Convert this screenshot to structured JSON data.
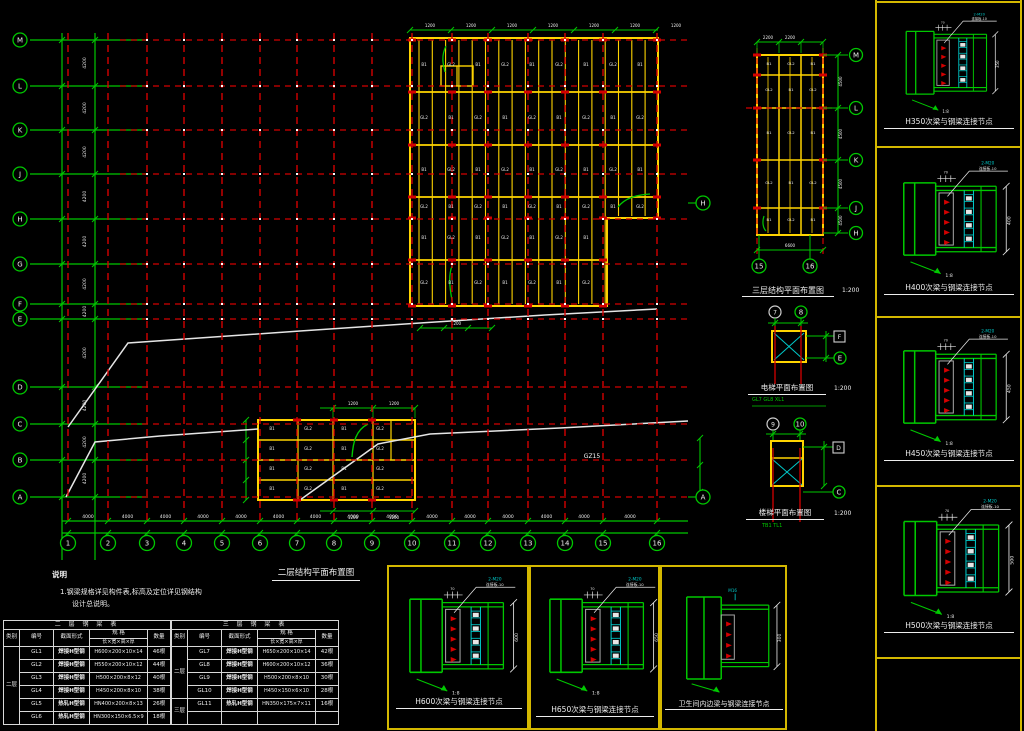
{
  "colors": {
    "green": "#00c800",
    "red": "#d40000",
    "yellow": "#ffd400",
    "panel_border": "#d4b800",
    "cyan": "#00c8c8",
    "white": "#ededed",
    "gray_plate": "#a8a8a8"
  },
  "axes": {
    "cols": [
      "1",
      "2",
      "3",
      "4",
      "5",
      "6",
      "7",
      "8",
      "9",
      "10",
      "11",
      "12",
      "13",
      "14",
      "15",
      "16"
    ],
    "rows": [
      "M",
      "L",
      "K",
      "J",
      "H",
      "G",
      "F",
      "E",
      "D",
      "C",
      "B",
      "A"
    ],
    "right_rows": [
      "H",
      "A"
    ],
    "strip_rows": [
      "M",
      "L",
      "K",
      "J",
      "H"
    ],
    "strip_cols": [
      "15",
      "16"
    ],
    "elevator_top": [
      "7",
      "8"
    ],
    "elevator_right": [
      "F",
      "E"
    ],
    "stair_top": [
      "9",
      "10"
    ],
    "stair_right": [
      "D",
      "C"
    ]
  },
  "plan": {
    "title": "二层结构平面布置图",
    "joist_marks": [
      "B1",
      "GL2"
    ],
    "column_label": "GZ15"
  },
  "strip": {
    "title": "三层结构平面布置图",
    "scale": "1:200"
  },
  "elevator": {
    "title": "电梯平面布置图",
    "scale": "1:200",
    "legend": "GL7  GL8  XL1"
  },
  "stair": {
    "title": "楼梯平面布置图",
    "scale": "1:200",
    "legend": "TB1  TL1"
  },
  "notes": {
    "heading": "说明",
    "line1": "1.钢梁规格详见构件表,标高及定位详见钢结构",
    "line2": "设计总说明。"
  },
  "right_panels": [
    {
      "title": "H350次梁与钢梁连接节点",
      "dim": "350"
    },
    {
      "title": "H400次梁与钢梁连接节点",
      "dim": "400"
    },
    {
      "title": "H450次梁与钢梁连接节点",
      "dim": "450"
    },
    {
      "title": "H500次梁与钢梁连接节点",
      "dim": "500"
    }
  ],
  "bottom_panels": [
    {
      "title": "H600次梁与钢梁连接节点",
      "dim": "600"
    },
    {
      "title": "H650次梁与钢梁连接节点",
      "dim": "650"
    },
    {
      "title": "卫生间内边梁与钢梁连接节点",
      "dim": "300"
    }
  ],
  "detail_annotations": {
    "bolt": "2-M20",
    "plate": "连接板-10",
    "spacing": "70",
    "slope": "1:8",
    "wc_bolt": "M16"
  },
  "dims": {
    "row": "4200",
    "col": "4000",
    "strip_col": "2200",
    "strip_row": "4500",
    "strip_total": "6600",
    "small": "1200"
  },
  "table": {
    "headers": {
      "category": "类别",
      "mark": "编号",
      "section_type": "截面形式",
      "size": "规 格",
      "size_sub": "长×宽×高×厚",
      "qty": "数量"
    },
    "left": {
      "group_header": "二 层 钢 梁 表",
      "spans": [
        {
          "label": "二层",
          "count": 6
        }
      ],
      "rows": [
        [
          "GL1",
          "焊接H型钢",
          "H600×200×10×14",
          "46根"
        ],
        [
          "GL2",
          "焊接H型钢",
          "H550×200×10×12",
          "44根"
        ],
        [
          "GL3",
          "焊接H型钢",
          "H500×200×8×12",
          "40根"
        ],
        [
          "GL4",
          "焊接H型钢",
          "H450×200×8×10",
          "38根"
        ],
        [
          "GL5",
          "热轧H型钢",
          "HN400×200×8×13",
          "26根"
        ],
        [
          "GL6",
          "热轧H型钢",
          "HN300×150×6.5×9",
          "18根"
        ]
      ]
    },
    "right": {
      "group_header": "三 层 钢 梁 表",
      "spans": [
        {
          "label": "二层",
          "count": 4
        },
        {
          "label": "三层",
          "count": 2
        }
      ],
      "rows": [
        [
          "GL7",
          "焊接H型钢",
          "H650×200×10×14",
          "42根"
        ],
        [
          "GL8",
          "焊接H型钢",
          "H600×200×10×12",
          "36根"
        ],
        [
          "GL9",
          "焊接H型钢",
          "H500×200×8×10",
          "30根"
        ],
        [
          "GL10",
          "焊接H型钢",
          "H450×150×6×10",
          "28根"
        ],
        [
          "GL11",
          "热轧H型钢",
          "HN350×175×7×11",
          "16根"
        ],
        [
          "",
          "",
          "",
          ""
        ]
      ]
    }
  }
}
